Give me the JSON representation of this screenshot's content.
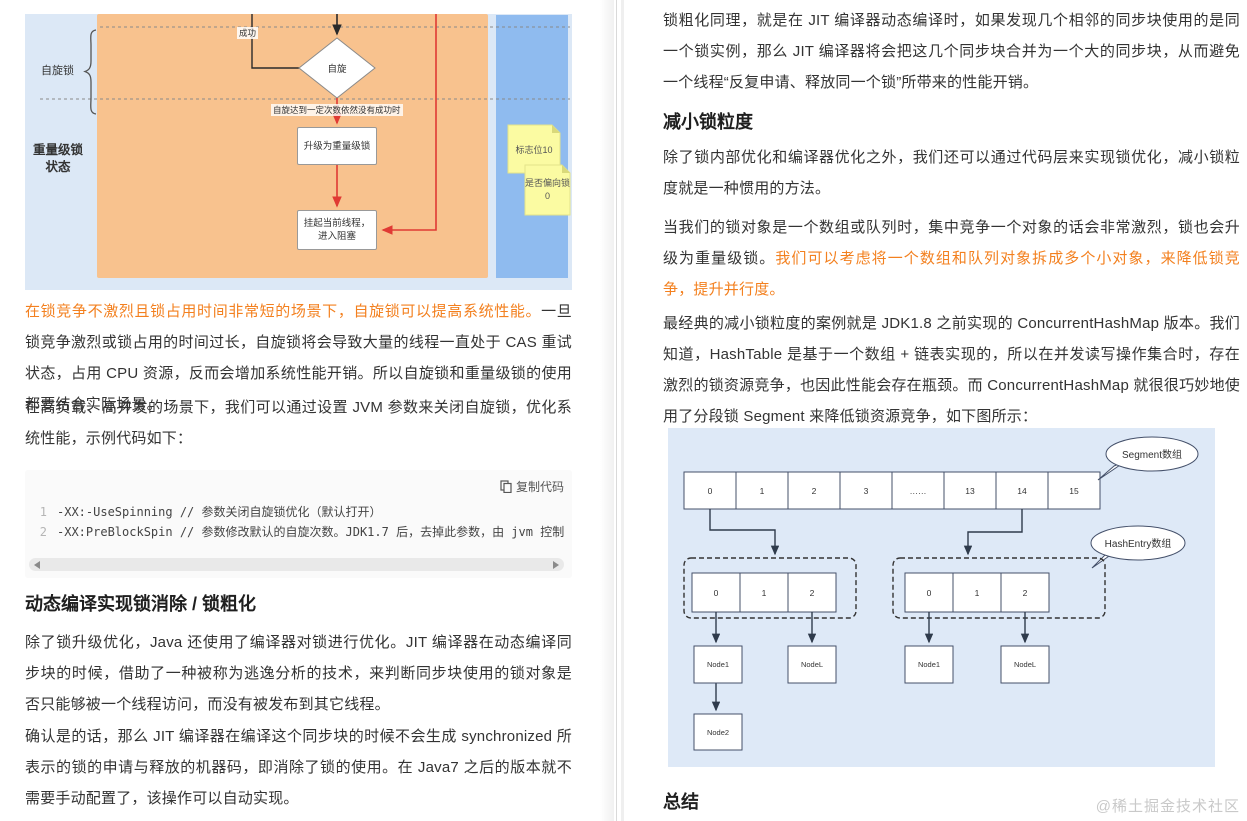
{
  "left": {
    "figure": {
      "label_spin_lock": "自旋锁",
      "label_heavy_state": "重量级锁状态",
      "label_success": "成功",
      "diamond_spin": "自旋",
      "spin_fail_note": "自旋达到一定次数依然没有成功时",
      "box_upgrade": "升级为重量级锁",
      "box_suspend": "挂起当前线程，进入阻塞",
      "sticky_note_1": "标志位10",
      "sticky_note_2": "是否偏向锁 0"
    },
    "p1_highlight": "在锁竞争不激烈且锁占用时间非常短的场景下，自旋锁可以提高系统性能。",
    "p1_rest": "一旦锁竞争激烈或锁占用的时间过长，自旋锁将会导致大量的线程一直处于 CAS 重试状态，占用 CPU 资源，反而会增加系统性能开销。所以自旋锁和重量级锁的使用都要结合实际场景。",
    "p2": "在高负载、高并发的场景下，我们可以通过设置 JVM 参数来关闭自旋锁，优化系统性能，示例代码如下：",
    "code": {
      "copy_label": "复制代码",
      "lines": [
        {
          "no": "1",
          "text": "-XX:-UseSpinning // 参数关闭自旋锁优化（默认打开）"
        },
        {
          "no": "2",
          "text": "-XX:PreBlockSpin // 参数修改默认的自旋次数。JDK1.7 后，去掉此参数，由 jvm 控制"
        }
      ]
    },
    "h2": "动态编译实现锁消除 / 锁粗化",
    "p3": "除了锁升级优化，Java 还使用了编译器对锁进行优化。JIT 编译器在动态编译同步块的时候，借助了一种被称为逃逸分析的技术，来判断同步块使用的锁对象是否只能够被一个线程访问，而没有被发布到其它线程。",
    "p4": "确认是的话，那么 JIT 编译器在编译这个同步块的时候不会生成 synchronized 所表示的锁的申请与释放的机器码，即消除了锁的使用。在 Java7 之后的版本就不需要手动配置了，该操作可以自动实现。"
  },
  "right": {
    "p1": "锁粗化同理，就是在 JIT 编译器动态编译时，如果发现几个相邻的同步块使用的是同一个锁实例，那么 JIT 编译器将会把这几个同步块合并为一个大的同步块，从而避免一个线程“反复申请、释放同一个锁”所带来的性能开销。",
    "h2_granularity": "减小锁粒度",
    "p2": "除了锁内部优化和编译器优化之外，我们还可以通过代码层来实现锁优化，减小锁粒度就是一种惯用的方法。",
    "p3_black": "当我们的锁对象是一个数组或队列时，集中竞争一个对象的话会非常激烈，锁也会升级为重量级锁。",
    "p3_highlight": "我们可以考虑将一个数组和队列对象拆成多个小对象，来降低锁竞争，提升并行度。",
    "p4": "最经典的减小锁粒度的案例就是 JDK1.8 之前实现的 ConcurrentHashMap 版本。我们知道，HashTable 是基于一个数组 + 链表实现的，所以在并发读写操作集合时，存在激烈的锁资源竞争，也因此性能会存在瓶颈。而 ConcurrentHashMap 就很很巧妙地使用了分段锁 Segment 来降低锁资源竞争，如下图所示：",
    "diagram": {
      "segment_label": "Segment数组",
      "hashentry_label": "HashEntry数组",
      "segment_cells": [
        "0",
        "1",
        "2",
        "3",
        "……",
        "13",
        "14",
        "15"
      ],
      "left_entry_cells": [
        "0",
        "1",
        "2"
      ],
      "right_entry_cells": [
        "0",
        "1",
        "2"
      ],
      "left_node_1": "Node1",
      "left_node_L": "NodeL",
      "left_node_2": "Node2",
      "right_node_1": "Node1",
      "right_node_L": "NodeL"
    },
    "h2_summary": "总结"
  },
  "watermark": "@稀土掘金技术社区",
  "colors": {
    "highlight_text": "#f3801f",
    "flow_red": "#e03a34",
    "figure_bg": "#dce8f6",
    "orange_panel": "#f8c28e",
    "blue_strip": "#8fbbef",
    "sticky_yellow": "#fbfba2",
    "diagram_bg": "#dee9f7",
    "watermark_gray": "#c9c9c9"
  }
}
